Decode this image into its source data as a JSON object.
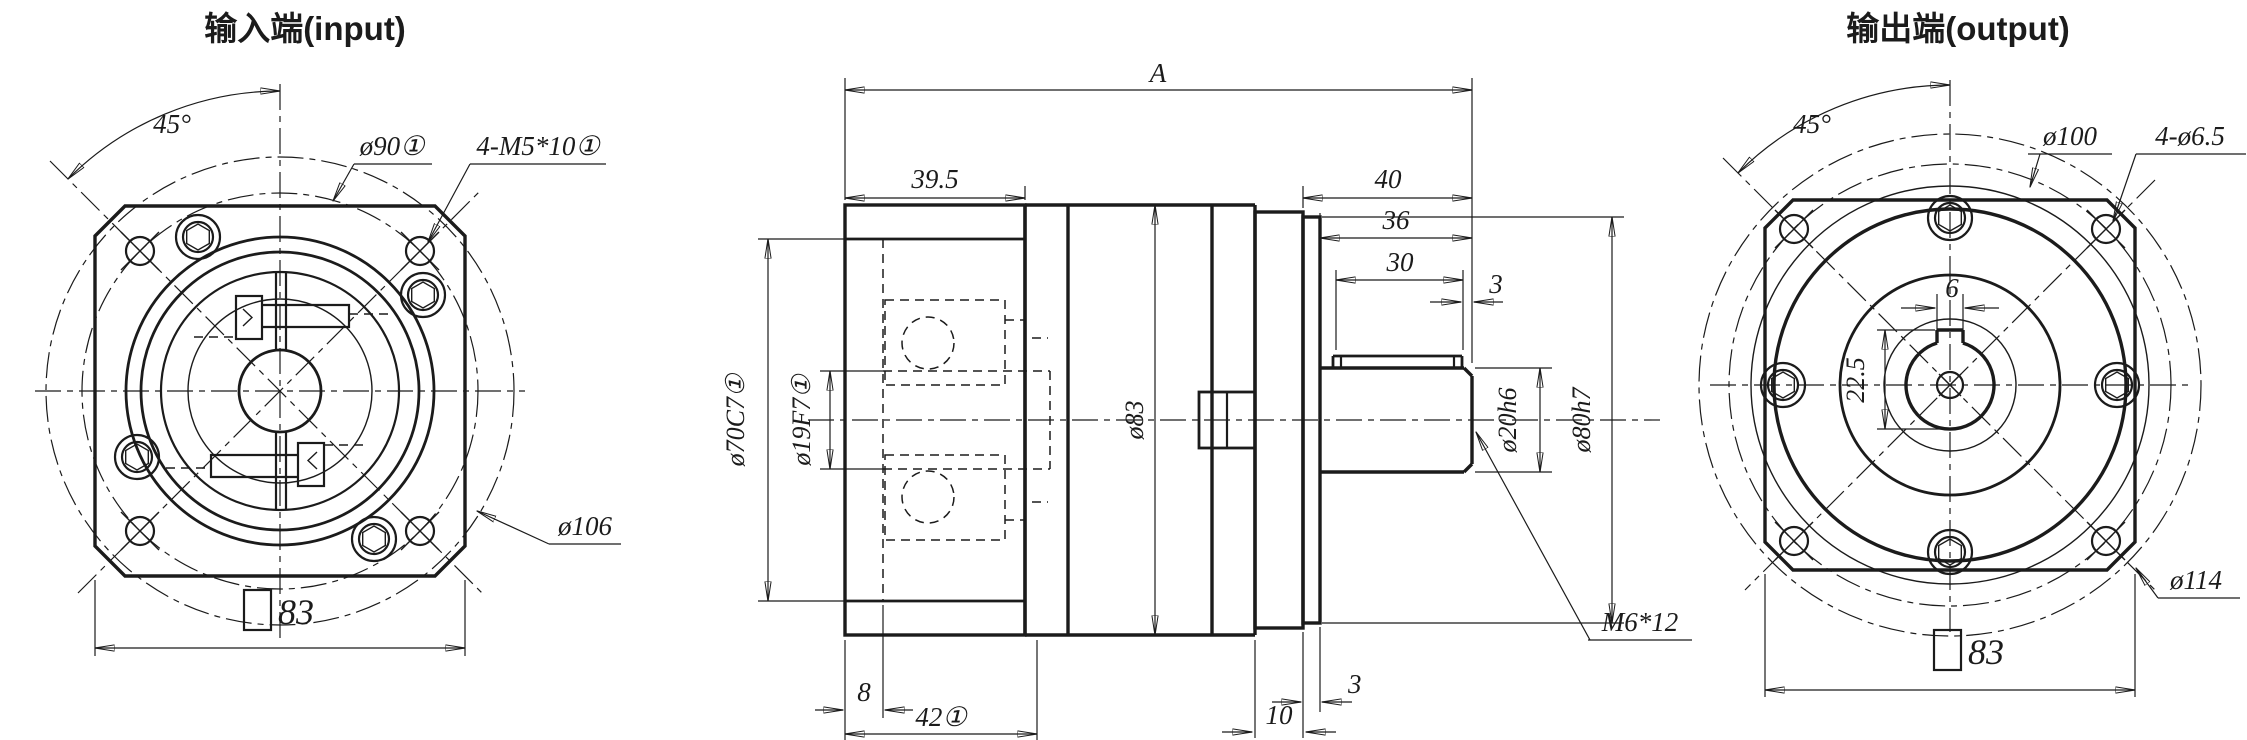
{
  "drawing": {
    "input_view": {
      "title": "输入端(input)",
      "angle": "45°",
      "bolt_circle": "ø90①",
      "corner_holes": "4-M5*10①",
      "flange_dia": "ø106",
      "square_side": "83"
    },
    "side_view": {
      "total_len": "A",
      "input_depth": "39.5",
      "shaft_end_len": "40",
      "len_36": "36",
      "key_len": "30",
      "key_tip_gap": "3",
      "body_dia": "ø83",
      "pilot_dia": "ø70C7①",
      "bore_dia": "ø19F7①",
      "shaft_dia": "ø20h6",
      "spigot_dia": "ø80h7",
      "tip_tap": "M6*12",
      "recess_depth": "8",
      "flange_len": "42①",
      "plate_len": "10",
      "spigot_len": "3"
    },
    "output_view": {
      "title": "输出端(output)",
      "angle": "45°",
      "bolt_circle": "ø100",
      "corner_holes": "4-ø6.5",
      "corner_dia": "ø114",
      "square_side": "83",
      "key_width": "6",
      "key_height": "22.5"
    }
  }
}
